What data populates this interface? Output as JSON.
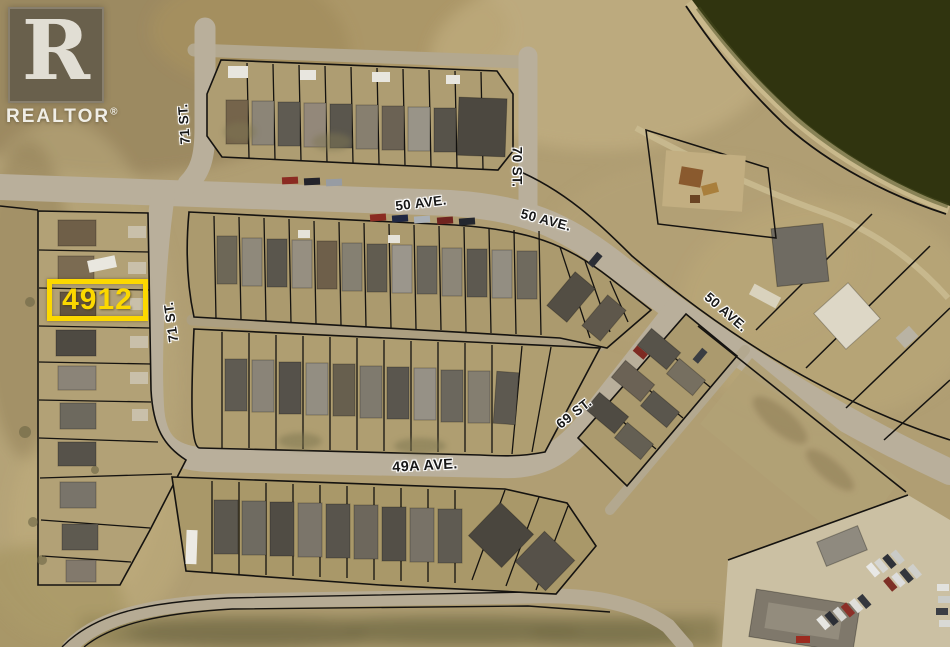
{
  "watermark": {
    "logo_letter": "R",
    "brand": "REALTOR",
    "registered_mark": "®"
  },
  "highlight": {
    "lot_number": "4912"
  },
  "labels": {
    "st71_top": "71 ST.",
    "ave50_left": "50 AVE.",
    "ave50_mid": "50 AVE.",
    "st70": "70 ST.",
    "ave50_right": "50 AVE.",
    "st71_mid": "71 ST.",
    "st69": "69 ST.",
    "ave49a": "49A AVE."
  },
  "colors": {
    "highlight_accent": "#fcd800",
    "parcel_line": "#151310",
    "water": "#30340f",
    "land": "#b09e73",
    "road": "#b9af9b",
    "label_text": "#181818",
    "label_halo": "#ffffff"
  }
}
